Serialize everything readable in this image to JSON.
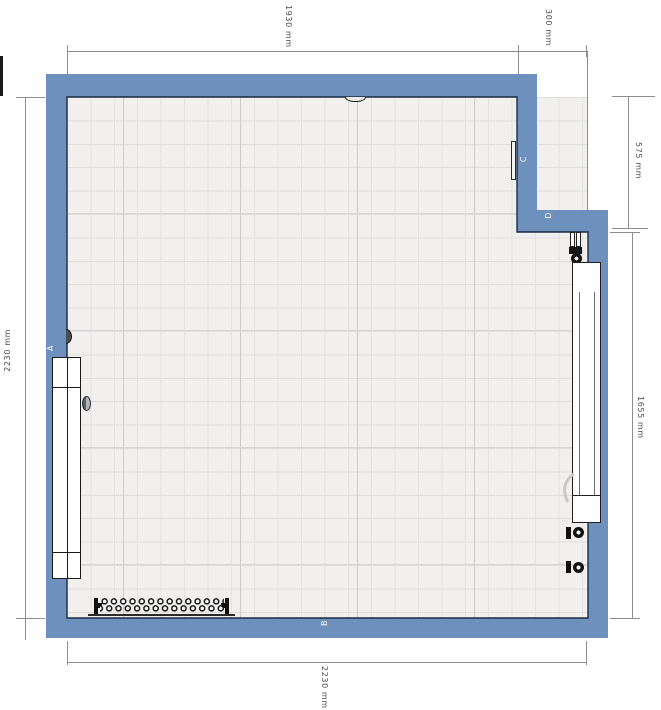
{
  "dimension_labels": {
    "top_main": "1930 mm",
    "top_right": "300 mm",
    "left_side": "2230 mm",
    "bottom": "2230 mm",
    "right_upper": "575 mm",
    "right_lower": "1655 mm"
  },
  "wall_labels": {
    "a": "A",
    "b": "B",
    "c": "C",
    "d": "D"
  },
  "colors": {
    "wall_fill": "#6d90bc",
    "wall_outline": "#1c2b42",
    "floor": "#f1f0ef",
    "grid_line": "#e2e1e0",
    "dimension_line": "#8d8d8d",
    "dimension_text": "#4f4f4f",
    "wall_label_text": "#ffffff"
  },
  "fixtures": [
    "sliding-door",
    "door-handle",
    "door-hinge",
    "ceiling-vent-icon",
    "flush-wall-switch",
    "column-radiator",
    "towel-radiator",
    "radiator-valve",
    "radiator-pipes"
  ]
}
